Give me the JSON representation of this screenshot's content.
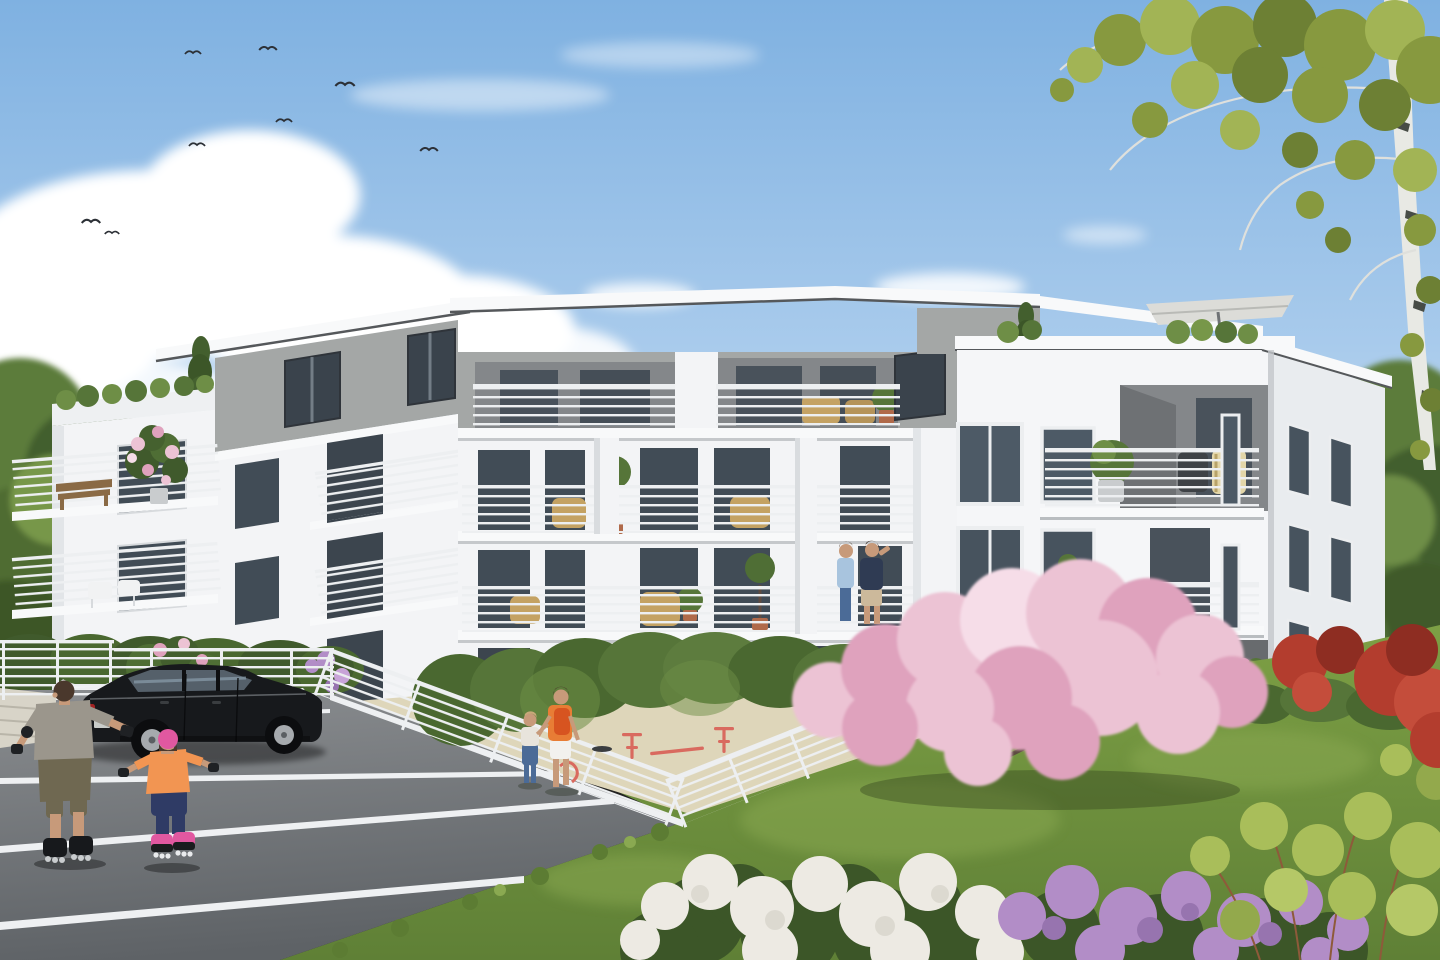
{
  "meta": {
    "title": "Architectural rendering — modern white apartment building with courtyard, car park and playground",
    "scene_type": "photorealistic exterior visualization, sunny day",
    "canvas": {
      "width": 1440,
      "height": 960
    }
  },
  "palette": {
    "sky_top": "#7fb1e1",
    "sky_mid": "#a9cbec",
    "sky_low": "#d8e7f4",
    "cloud": "#ffffff",
    "bird": "#2c3036",
    "tree_dark": "#435f2e",
    "tree_mid": "#5b7b3a",
    "tree_light": "#779749",
    "birch_trunk": "#e8e9e4",
    "birch_mark": "#474c46",
    "birch_leaf": "#87993f",
    "birch_leaf_light": "#a2b455",
    "birch_leaf_dark": "#6d8034",
    "wall_white": "#f3f4f6",
    "wall_shade": "#e2e5e8",
    "wall_dark": "#cdd1d4",
    "gray_floor": "#a4a7a6",
    "recess": "#84878a",
    "recess_dark": "#686b6e",
    "roof_white": "#f8f9fa",
    "roof_edge": "#55585b",
    "glass": "#414c56",
    "glass_light": "#6b7884",
    "frame_white": "#eceef0",
    "frame_dark": "#2f343a",
    "blind": "#aab2b9",
    "railing": "#edeff1",
    "railing_post": "#c7cbce",
    "wicker": "#c4a263",
    "wood": "#8a6a45",
    "pot_terracotta": "#b06a4a",
    "hedge": "#567539",
    "hedge_dark": "#405a2c",
    "hedge_light": "#6e8e46",
    "lawn": "#74953f",
    "lawn_light": "#8aa951",
    "lawn_dark": "#5c7c33",
    "asphalt": "#85888c",
    "asphalt_dark": "#5e6266",
    "line_white": "#eef0f2",
    "sand": "#ded6ba",
    "concrete": "#d8d4c8",
    "car_body": "#17191c",
    "car_window": "#55606a",
    "car_rim": "#a6aaae",
    "car_tail": "#a32222",
    "blossom": "#ecc3d4",
    "blossom_deep": "#dfa2bd",
    "blossom_light": "#f6dde8",
    "branch": "#5d4b41",
    "hyd_white": "#edeae3",
    "hyd_purple": "#b28dc7",
    "hyd_purple_dark": "#9774af",
    "leaf_dark": "#3c5628",
    "shrub_yellow": "#a9be5a",
    "shrub_red": "#b33d2e",
    "shrub_red_dark": "#8e2d22",
    "skin": "#c79a7a",
    "hair_brown": "#4a382c",
    "man_shirt": "#9b968c",
    "man_pants": "#6f6851",
    "girl_top": "#f29552",
    "girl_pants": "#2f3b65",
    "girl_helmet": "#e158a0",
    "woman_top": "#e87d35",
    "backpack": "#d75420",
    "shorts_white": "#f2f1ee",
    "jeans": "#4b6b97",
    "polo_navy": "#2f3b53",
    "khaki": "#ccb99b",
    "equip_red": "#d96a5f",
    "shadow_soft": "rgba(25,35,18,0.30)"
  },
  "sky": {
    "description": "clear blue sky with scattered cumulus clouds",
    "birds_count": 8
  },
  "building": {
    "floors": 4,
    "style": "modern white-render apartment block, angled wings around a courtyard",
    "top_floor": "recessed grey penthouse level under a thin white flat-roof slab",
    "balcony_railings": "white horizontal-bar metal railings on continuous balconies",
    "roof_terrace": "roof terrace on the right tower with parasol and planted hedge",
    "left_wing_feature": "wrap-around corner balconies, pink climbing plant, timber bench",
    "right_wing_feature": "corner loggia with wicker furniture and narrow slot windows"
  },
  "people": [
    {
      "id": "rollerblading-man",
      "description": "man in grey t-shirt and olive cargo pants inline-skating across the car park"
    },
    {
      "id": "rollerblading-girl",
      "description": "child with pink helmet, orange top and navy pants skating behind him"
    },
    {
      "id": "woman-with-toddler",
      "description": "woman in orange top with red backpack leading a toddler across the playground"
    },
    {
      "id": "balcony-man-blue",
      "description": "man in light blue shirt and jeans on a second-floor balcony"
    },
    {
      "id": "balcony-man-navy",
      "description": "man in navy polo and beige shorts on a second-floor balcony"
    }
  ],
  "vehicles": [
    {
      "id": "black-sedan",
      "description": "black saloon car parked in a marked bay",
      "color_ref": "car_body"
    }
  ],
  "landscape": {
    "parking": "grey asphalt with white bay markings and white horizontal-rail fences",
    "playground": "raised sand play area with red spring riders behind a white railing fence",
    "hedges": "clipped green hedges screening the ground-floor terraces",
    "flowering": "pink blossom tree, white and purple hydrangeas, red shrubs, lilac bush, pink roses",
    "trees": "silver birch overhanging from the top right, mature green trees behind the building"
  }
}
